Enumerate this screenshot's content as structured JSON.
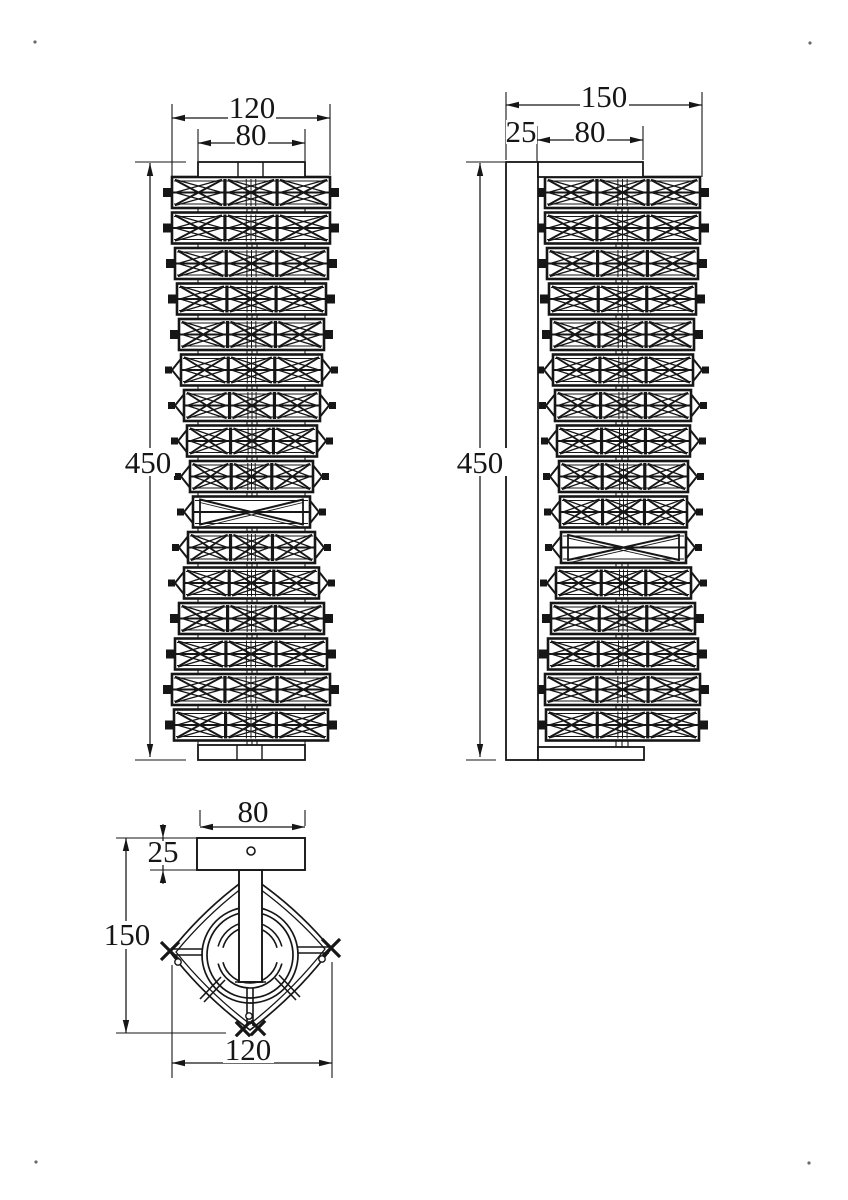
{
  "canvas": {
    "w": 848,
    "h": 1200,
    "bg": "#ffffff",
    "ink": "#161616"
  },
  "band_layout": {
    "y0": 177,
    "pitch": 35.5,
    "h": 31
  },
  "front": {
    "bands": [
      [
        172,
        330,
        "sq"
      ],
      [
        172,
        330,
        "sq"
      ],
      [
        175,
        328,
        "sq"
      ],
      [
        177,
        326,
        "sq"
      ],
      [
        179,
        324,
        "sq"
      ],
      [
        181,
        322,
        "cap"
      ],
      [
        184,
        320,
        "cap"
      ],
      [
        187,
        317,
        "cap"
      ],
      [
        190,
        313,
        "cap"
      ],
      [
        193,
        310,
        "open"
      ],
      [
        188,
        315,
        "cap"
      ],
      [
        184,
        319,
        "cap"
      ],
      [
        179,
        324,
        "sq"
      ],
      [
        175,
        327,
        "sq"
      ],
      [
        172,
        330,
        "sq"
      ],
      [
        174,
        328,
        "sq"
      ]
    ],
    "plates": [
      {
        "r": [
          198,
          162,
          107,
          15
        ],
        "dividers": [
          238,
          263
        ]
      },
      {
        "r": [
          198,
          745,
          107,
          15
        ],
        "dividers": [
          237,
          262
        ]
      }
    ],
    "guides": {
      "xs": [
        198,
        247,
        252,
        257,
        305
      ],
      "y1": 177,
      "y2": 745
    }
  },
  "side": {
    "bands": [
      [
        545,
        700,
        "sq"
      ],
      [
        545,
        700,
        "sq"
      ],
      [
        547,
        698,
        "sq"
      ],
      [
        549,
        696,
        "sq"
      ],
      [
        551,
        694,
        "sq"
      ],
      [
        553,
        693,
        "cap"
      ],
      [
        555,
        691,
        "cap"
      ],
      [
        557,
        690,
        "cap"
      ],
      [
        559,
        688,
        "cap"
      ],
      [
        560,
        687,
        "cap"
      ],
      [
        561,
        686,
        "open"
      ],
      [
        556,
        691,
        "cap"
      ],
      [
        551,
        695,
        "sq"
      ],
      [
        548,
        698,
        "sq"
      ],
      [
        545,
        700,
        "sq"
      ],
      [
        546,
        699,
        "sq"
      ]
    ],
    "wall_plate": [
      506,
      162,
      32,
      598
    ],
    "brackets": [
      [
        538,
        162,
        105,
        15
      ],
      [
        538,
        747,
        106,
        13
      ]
    ],
    "guides": {
      "xs": [
        616,
        622,
        628
      ],
      "y1": 178,
      "y2": 747
    }
  },
  "bottom": {
    "plate": [
      197,
      838,
      108,
      32
    ],
    "hole": [
      251,
      851,
      4
    ],
    "stem": [
      239,
      870,
      23,
      112
    ],
    "stem_foot": [
      235,
      982,
      266,
      982
    ],
    "center": [
      250,
      955
    ],
    "circle_radii": [
      48,
      43
    ],
    "arc_radii": [
      33,
      28
    ],
    "arc_segments": [
      [
        -165,
        -100
      ],
      [
        -80,
        -15
      ],
      [
        15,
        165
      ]
    ],
    "diamond": {
      "left": [
        170,
        952
      ],
      "top": [
        250,
        876
      ],
      "right": [
        331,
        949
      ],
      "bottom": [
        250,
        1030
      ],
      "bulge": 8,
      "inset": 6
    },
    "connectors": [
      [
        172,
        949,
        203,
        949
      ],
      [
        172,
        955,
        203,
        955
      ],
      [
        298,
        947,
        329,
        947
      ],
      [
        298,
        953,
        329,
        953
      ],
      [
        221,
        977,
        200,
        999
      ],
      [
        225,
        980,
        204,
        1002
      ],
      [
        279,
        975,
        300,
        997
      ],
      [
        275,
        978,
        296,
        1000
      ],
      [
        247,
        988,
        247,
        1026
      ],
      [
        253,
        988,
        253,
        1026
      ]
    ],
    "xmarks": [
      [
        170,
        951,
        10
      ],
      [
        331,
        948,
        10
      ],
      [
        243,
        1029,
        8
      ],
      [
        258,
        1028,
        8
      ]
    ],
    "small_circles": [
      [
        178,
        962,
        3.2
      ],
      [
        322,
        959,
        3.2
      ],
      [
        249,
        1016,
        3.2
      ]
    ]
  },
  "dims": [
    {
      "label": "120",
      "line": [
        172,
        118,
        330,
        118
      ],
      "arrows": [
        [
          172,
          118,
          "l"
        ],
        [
          330,
          118,
          "r"
        ]
      ],
      "exts": [
        [
          172,
          104,
          172,
          176
        ],
        [
          330,
          104,
          330,
          175
        ]
      ],
      "text": [
        252,
        118
      ],
      "bg": [
        228,
        96,
        48,
        24
      ]
    },
    {
      "label": "80",
      "line": [
        198,
        143,
        305,
        143
      ],
      "arrows": [
        [
          198,
          143,
          "l"
        ],
        [
          305,
          143,
          "r"
        ]
      ],
      "exts": [
        [
          198,
          129,
          198,
          161
        ],
        [
          305,
          129,
          305,
          161
        ]
      ],
      "text": [
        251,
        145
      ],
      "bg": [
        235,
        123,
        33,
        24
      ]
    },
    {
      "label": "450",
      "line": [
        150,
        163,
        150,
        757
      ],
      "arrows": [
        [
          150,
          163,
          "u"
        ],
        [
          150,
          757,
          "d"
        ]
      ],
      "exts": [
        [
          135,
          162,
          186,
          162
        ],
        [
          135,
          760,
          186,
          760
        ]
      ],
      "text": [
        148,
        473
      ],
      "bg": [
        122,
        448,
        53,
        28
      ]
    },
    {
      "label": "150",
      "line": [
        506,
        105,
        702,
        105
      ],
      "arrows": [
        [
          506,
          105,
          "l"
        ],
        [
          702,
          105,
          "r"
        ]
      ],
      "exts": [
        [
          506,
          92,
          506,
          160
        ],
        [
          702,
          92,
          702,
          177
        ]
      ],
      "text": [
        604,
        107
      ],
      "bg": [
        580,
        85,
        49,
        24
      ]
    },
    {
      "label": "25",
      "line": [
        506,
        140,
        537,
        140
      ],
      "arrows": [
        [
          506,
          140,
          "l"
        ],
        [
          537,
          140,
          "r"
        ]
      ],
      "exts": [
        [
          537,
          126,
          537,
          161
        ]
      ],
      "text": [
        521,
        142
      ],
      "bg": [
        506,
        120,
        31,
        24
      ]
    },
    {
      "label": "80",
      "line": [
        537,
        140,
        643,
        140
      ],
      "arrows": [
        [
          537,
          140,
          "l"
        ],
        [
          643,
          140,
          "r"
        ]
      ],
      "exts": [
        [
          643,
          126,
          643,
          160
        ]
      ],
      "text": [
        590,
        142
      ],
      "bg": [
        574,
        120,
        33,
        24
      ]
    },
    {
      "label": "450",
      "line": [
        480,
        163,
        480,
        757
      ],
      "arrows": [
        [
          480,
          163,
          "u"
        ],
        [
          480,
          757,
          "d"
        ]
      ],
      "exts": [
        [
          466,
          162,
          505,
          162
        ],
        [
          466,
          760,
          496,
          760
        ]
      ],
      "text": [
        480,
        473
      ],
      "bg": [
        454,
        448,
        53,
        28
      ]
    },
    {
      "label": "80",
      "line": [
        200,
        827,
        305,
        827
      ],
      "arrows": [
        [
          200,
          827,
          "l"
        ],
        [
          305,
          827,
          "r"
        ]
      ],
      "exts": [
        [
          200,
          810,
          200,
          826
        ],
        [
          305,
          810,
          305,
          826
        ]
      ],
      "text": [
        253,
        822
      ]
    },
    {
      "label": "25",
      "line": [
        163,
        838,
        163,
        870
      ],
      "arrows": [
        [
          163,
          838,
          "d"
        ],
        [
          163,
          870,
          "u"
        ]
      ],
      "exts": [
        [
          163,
          824,
          163,
          838
        ],
        [
          163,
          870,
          163,
          884
        ],
        [
          116,
          838,
          197,
          838
        ],
        [
          150,
          870,
          197,
          870
        ]
      ],
      "text": [
        163,
        862
      ],
      "bg": [
        147,
        841,
        33,
        24
      ]
    },
    {
      "label": "150",
      "line": [
        126,
        838,
        126,
        1033
      ],
      "arrows": [
        [
          126,
          838,
          "u"
        ],
        [
          126,
          1033,
          "d"
        ]
      ],
      "exts": [
        [
          116,
          1033,
          226,
          1033
        ]
      ],
      "text": [
        127,
        945
      ],
      "bg": [
        102,
        921,
        51,
        28
      ]
    },
    {
      "label": "120",
      "line": [
        172,
        1063,
        332,
        1063
      ],
      "arrows": [
        [
          172,
          1063,
          "l"
        ],
        [
          332,
          1063,
          "r"
        ]
      ],
      "exts": [
        [
          172,
          965,
          172,
          1078
        ],
        [
          332,
          962,
          332,
          1078
        ]
      ],
      "text": [
        248,
        1060
      ],
      "bg": [
        223,
        1037,
        51,
        26
      ]
    }
  ],
  "corner_dots": [
    [
      35,
      42
    ],
    [
      810,
      43
    ],
    [
      36,
      1162
    ],
    [
      809,
      1163
    ]
  ]
}
